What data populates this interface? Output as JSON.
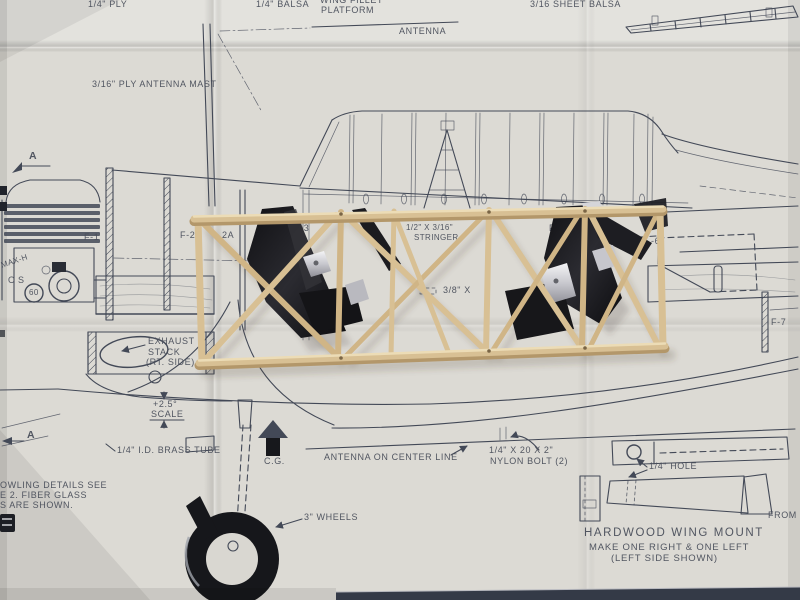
{
  "colors": {
    "paper": "#dcdad4",
    "ink": "#434957",
    "label": "#4a4f5b",
    "balsa": "#d8c094",
    "balsa-light": "#ecdcb6",
    "balsa-dark": "#b3976a",
    "seat": "#1c1c20",
    "metal": "#cfcfd5",
    "wheel": "#16171b",
    "edge": "#343a47"
  },
  "labels": {
    "quarter_ply": "1/4\" PLY",
    "quarter_balsa": "1/4\" BALSA",
    "wing_fillet_1": "WING FILLET",
    "wing_fillet_2": "PLATFORM",
    "antenna": "ANTENNA",
    "antenna_mast": "3/16\" PLY ANTENNA MAST",
    "sheet_balsa": "3/16 SHEET BALSA",
    "f1": "F-1",
    "f2": "F-2",
    "f2a": "2A",
    "f3": "F-3",
    "f5": "F-5",
    "f6": "-6",
    "f7": "F-7",
    "stringer_size": "1/2\" X 3/16\"",
    "stringer_word": "STRINGER",
    "crossmember": "3/8\" X",
    "exhaust_1": "EXHAUST",
    "exhaust_2": "STACK",
    "exhaust_3": "(RT. SIDE)",
    "scale_plus": "+2.5°",
    "scale_word": "SCALE",
    "brass_tube": "1/4\" I.D. BRASS TUBE",
    "cg": "C.G.",
    "antenna_center": "ANTENNA ON CENTER LINE",
    "nylon_1": "1/4\" X 20 X 2\"",
    "nylon_2": "NYLON BOLT (2)",
    "hole": "1/4\" HOLE",
    "from_s": "FROM S",
    "mount_1": "HARDWOOD WING MOUNT",
    "mount_2": "MAKE ONE RIGHT & ONE LEFT",
    "mount_3": "(LEFT SIDE SHOWN)",
    "wheels": "3\" WHEELS",
    "note_1": "OWLING DETAILS SEE",
    "note_2": "E 2. FIBER GLASS",
    "note_3": "S ARE SHOWN.",
    "engine_brand": "MAX-H",
    "engine_os": "OS",
    "engine_60": "60",
    "a_top": "A",
    "a_bottom": "A"
  }
}
